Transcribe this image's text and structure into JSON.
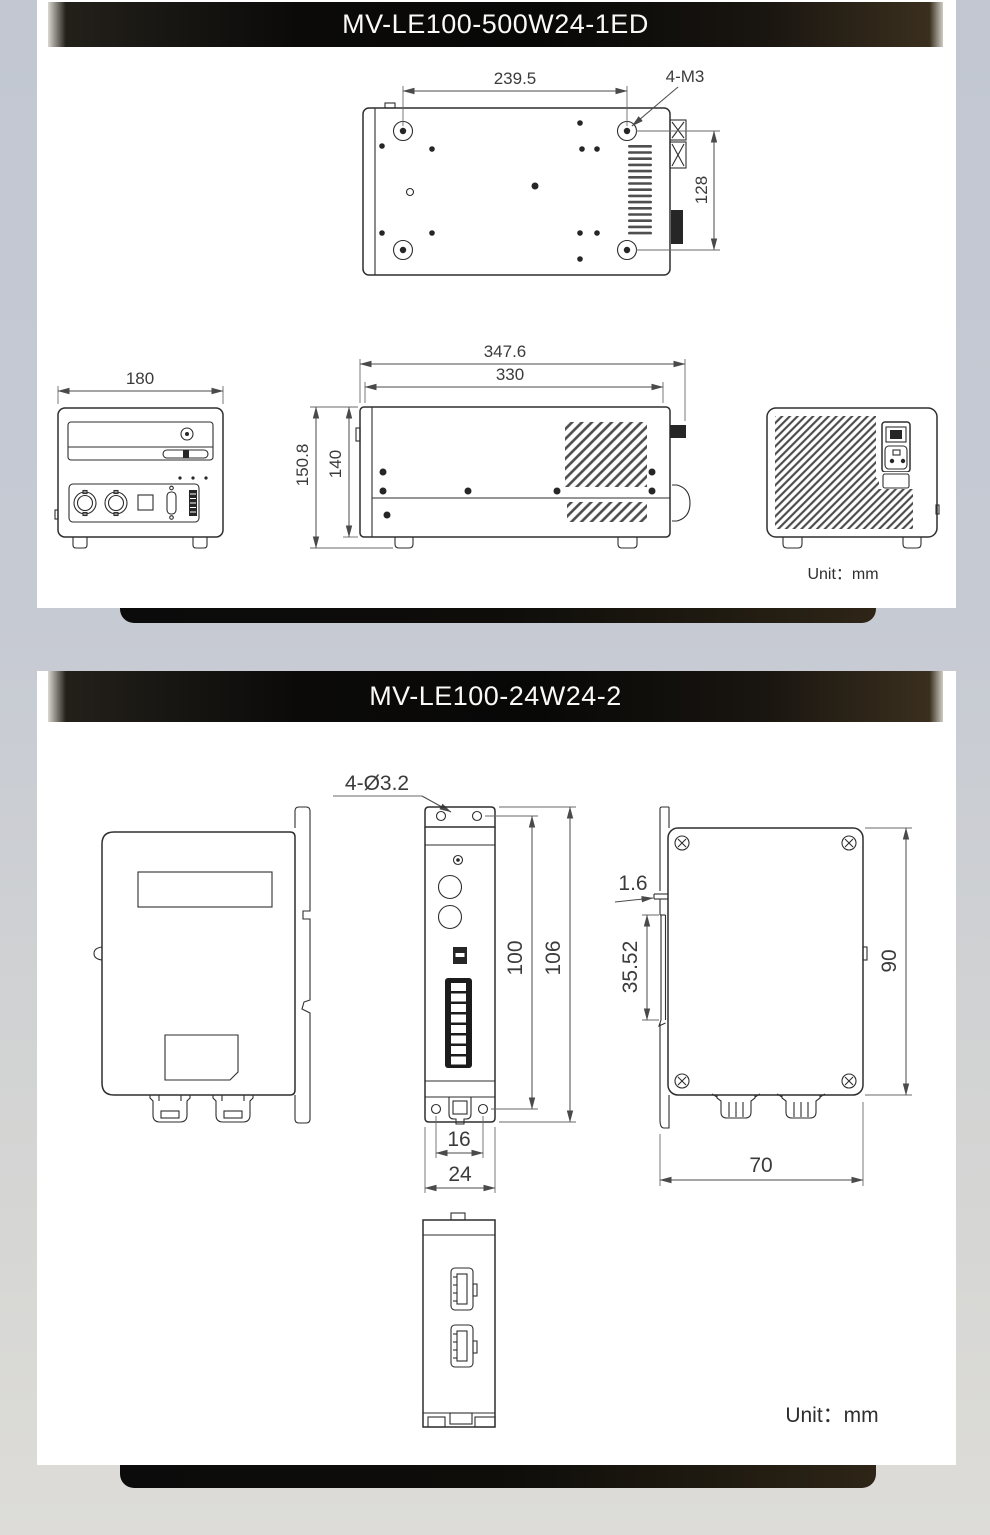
{
  "panel1": {
    "title": "MV-LE100-500W24-1ED",
    "unit_label": "Unit：mm",
    "top_view": {
      "width": "239.5",
      "thread_callout": "4-M3",
      "height": "128"
    },
    "front_view": {
      "width": "180"
    },
    "side_view": {
      "overall_width": "347.6",
      "body_width": "330",
      "overall_height": "150.8",
      "body_height": "140"
    }
  },
  "panel2": {
    "title": "MV-LE100-24W24-2",
    "unit_label": "Unit：mm",
    "front_view": {
      "hole_callout": "4-Ø3.2",
      "hole_span": "100",
      "overall_height": "106",
      "hole_pitch": "16",
      "width": "24"
    },
    "side_view": {
      "rail_lip": "1.6",
      "rail_slot": "35.52",
      "height": "90",
      "width": "70"
    }
  }
}
